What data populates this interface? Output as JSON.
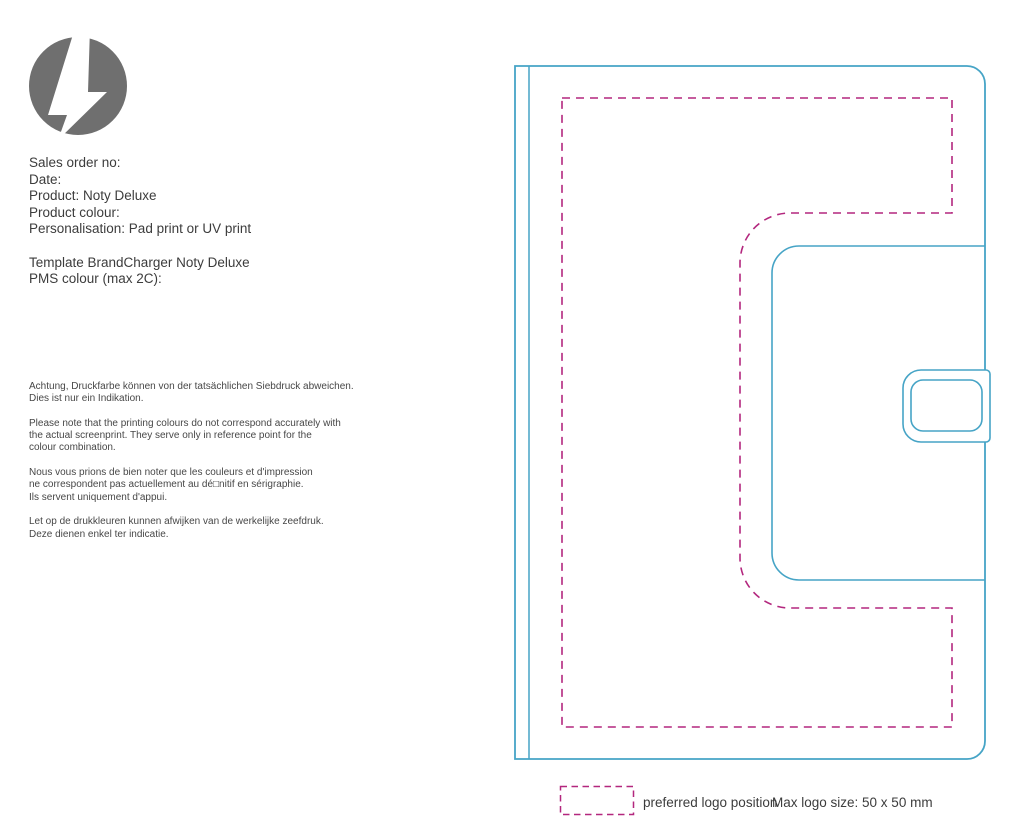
{
  "colors": {
    "outline_cyan": "#46A4C6",
    "print_area_magenta": "#B3277E",
    "logo_gray": "#6F6F6F",
    "text": "#3C3C3C"
  },
  "logo": {
    "icon": "lightning-bolt-icon"
  },
  "order_info": {
    "sales_order_label": "Sales order no:",
    "date_label": "Date:",
    "product": "Product: Noty Deluxe",
    "product_colour_label": "Product colour:",
    "personalisation": "Personalisation: Pad print or UV print",
    "template": "Template BrandCharger Noty Deluxe",
    "pms_colour_label": "PMS colour (max 2C):"
  },
  "disclaimer": {
    "de": "Achtung, Druckfarbe können von der tatsächlichen Siebdruck abweichen.\nDies ist nur ein Indikation.",
    "en": "Please note that the printing colours do not correspond accurately with\nthe actual screenprint. They serve only in reference point for the\ncolour combination.",
    "fr": "Nous vous prions de bien noter que les couleurs et d'impression\nne correspondent pas actuellement au dé□nitif en sérigraphie.\nIls servent uniquement d'appui.",
    "nl": "Let op de drukkleuren kunnen afwijken van de werkelijke zeefdruk.\nDeze dienen enkel ter indicatie."
  },
  "legend": {
    "swatch_icon": "dashed-rectangle-icon",
    "label": "preferred logo position",
    "max_size": "Max logo size: 50 x 50 mm"
  }
}
